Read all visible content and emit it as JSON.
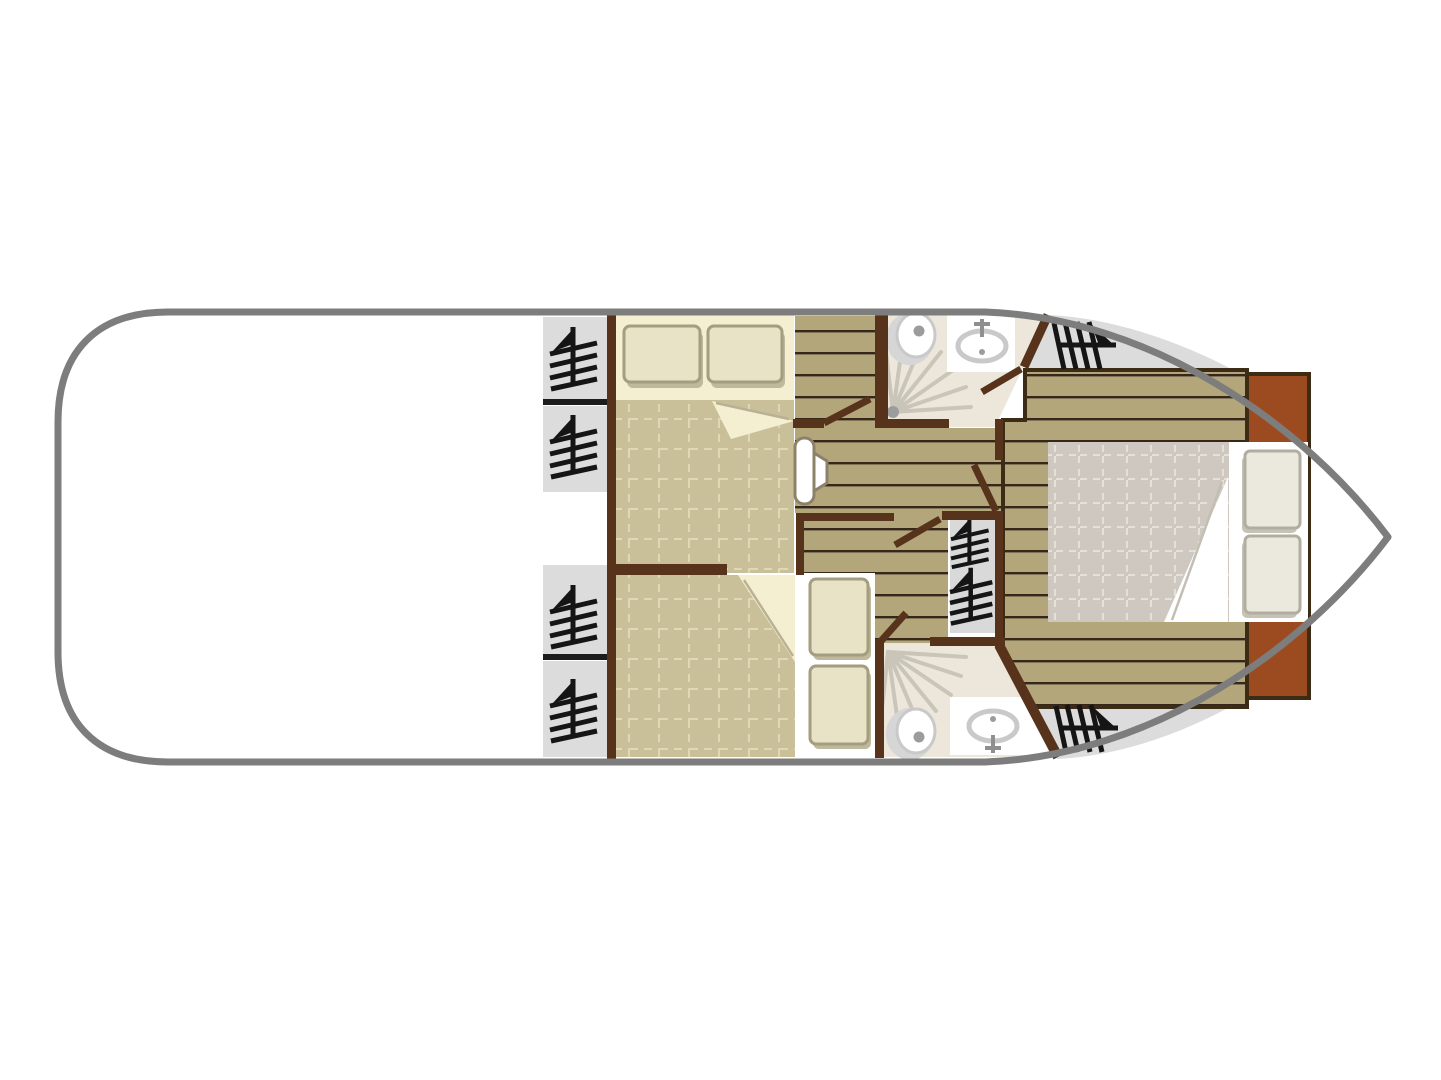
{
  "colors": {
    "hull": "#7d7d7d",
    "wall": "#56331a",
    "wall_dark": "#3c2c16",
    "rust": "#9c4b20",
    "window": "#dcdcdc",
    "stairs": "#d9d9d9",
    "sep": "#1c1c1c",
    "plank": "#b3a67b",
    "plank_line": "#35281a",
    "khaki": "#c9c099",
    "khaki_grid": "#ded8b7",
    "cream": "#f4efd1",
    "pillow": "#e8e2c6",
    "pillow_edge": "#a49d7f",
    "pillow_shadow": "#bfb89b",
    "bow_blanket": "#cec8c0",
    "bow_grid": "#e5e1d9",
    "bow_pillow": "#ebe8dd",
    "bow_pillow_edge": "#b1aea1",
    "bow_pillow_shadow": "#c6c3b6",
    "bath": "#ece7da",
    "fixture_ring": "#c9c9c9",
    "fixture_shadow": "#d6d6d6",
    "fixture_dot": "#9c9c9c",
    "faucet": "#8f8f8f",
    "ray": "#c9c5b9",
    "glyph": "#151515",
    "seat_edge": "#8d8168",
    "fold_line": "#b9b195",
    "bow_fold_line": "#c2beb2"
  },
  "inventory": {
    "cabins": 3,
    "double_beds": 3,
    "pillows": 6,
    "bathrooms": 2,
    "toilets": 2,
    "sinks": 2,
    "showers": 2,
    "side_window_hatches": 4,
    "bow_hatches": 2,
    "stair_flights": 2,
    "door_swings": 5
  }
}
